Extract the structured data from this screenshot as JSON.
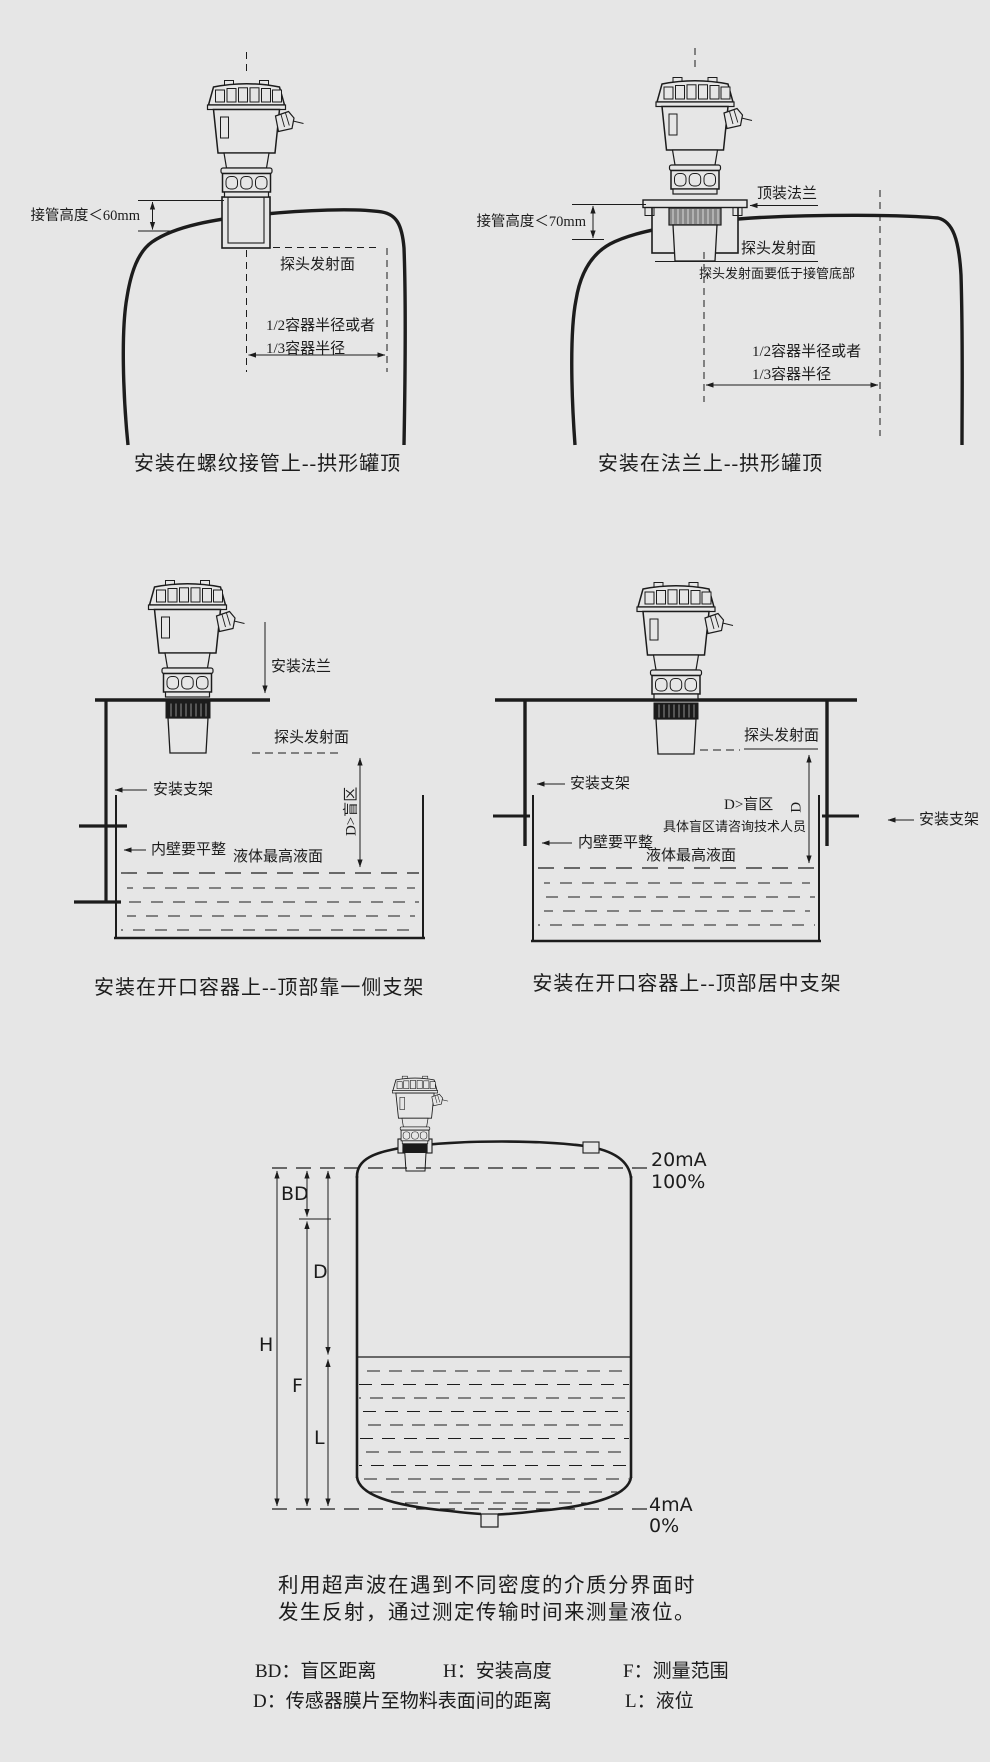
{
  "top_left": {
    "caption": "安装在螺纹接管上--拱形罐顶",
    "nozzle_height": "接管高度＜60mm",
    "probe_face": "探头发射面",
    "radius_line1": "1/2容器半径或者",
    "radius_line2": "1/3容器半径"
  },
  "top_right": {
    "caption": "安装在法兰上--拱形罐顶",
    "top_flange": "顶装法兰",
    "nozzle_height": "接管高度＜70mm",
    "probe_face": "探头发射面",
    "probe_face_note": "探头发射面要低于接管底部",
    "radius_line1": "1/2容器半径或者",
    "radius_line2": "1/3容器半径"
  },
  "middle_left": {
    "caption": "安装在开口容器上--顶部靠一侧支架",
    "mounting_flange": "安装法兰",
    "probe_face": "探头发射面",
    "bracket": "安装支架",
    "inner_wall_note": "内壁要平整",
    "max_liquid_level": "液体最高液面",
    "blind_zone": "D>盲区"
  },
  "middle_right": {
    "caption": "安装在开口容器上--顶部居中支架",
    "probe_face": "探头发射面",
    "bracket_left": "安装支架",
    "bracket_right": "安装支架",
    "inner_wall_note": "内壁要平整",
    "max_liquid_level": "液体最高液面",
    "blind_zone": "D>盲区",
    "dim_d": "D",
    "blind_zone_note": "具体盲区请咨询技术人员"
  },
  "bottom": {
    "dim_bd": "BD",
    "dim_d": "D",
    "dim_h": "H",
    "dim_f": "F",
    "dim_l": "L",
    "top_current": "20mA",
    "top_percent": "100%",
    "bottom_current": "4mA",
    "bottom_percent": "0%"
  },
  "description": {
    "line1": "利用超声波在遇到不同密度的介质分界面时",
    "line2": "发生反射，通过测定传输时间来测量液位。"
  },
  "legend": {
    "items": [
      {
        "text": "BD：盲区距离"
      },
      {
        "text": "H：安装高度"
      },
      {
        "text": "F：测量范围"
      },
      {
        "text": "D：传感器膜片至物料表面间的距离"
      },
      {
        "text": "L：液位"
      }
    ]
  }
}
